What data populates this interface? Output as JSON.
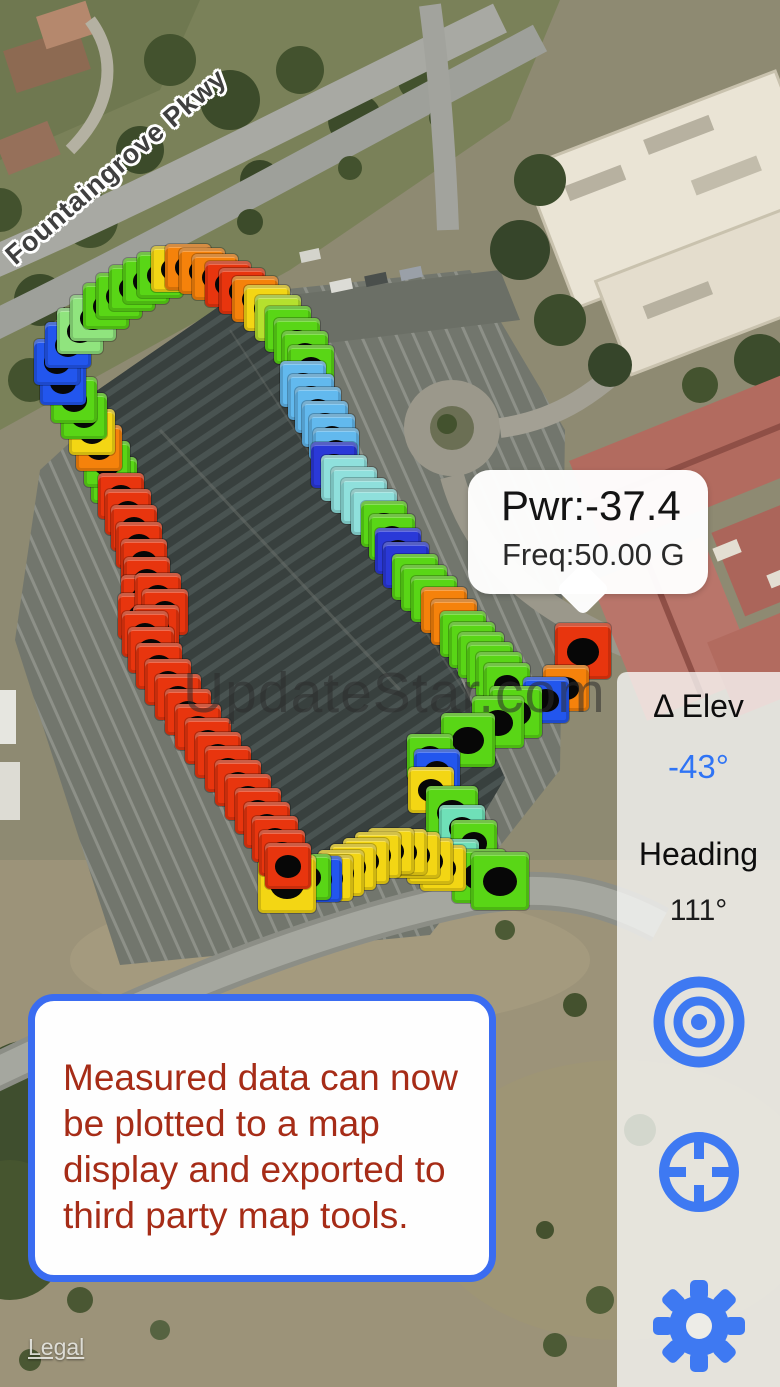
{
  "map": {
    "road_label": "Fountaingrove Pkwy",
    "legal_label": "Legal",
    "watermark": "UpdateStar.com"
  },
  "callout": {
    "power": "Pwr:-37.4",
    "freq": "Freq:50.00 G"
  },
  "sidebar": {
    "delta_elev_label": "Δ Elev",
    "delta_elev_value": "-43°",
    "heading_label": "Heading",
    "heading_value": "111°",
    "accent_color": "#3e79f2",
    "icons": [
      "bullseye-icon",
      "crosshair-icon",
      "gear-icon"
    ]
  },
  "note": {
    "lines": [
      "Measured data can now",
      "be plotted to a map",
      "display and exported to",
      "third party map tools."
    ],
    "text_color": "#a62c17",
    "border_color": "#3a6cf1"
  },
  "measurements": {
    "palette": {
      "r": "#e8350e",
      "o": "#f5820b",
      "y": "#f3d614",
      "yg": "#b5e02e",
      "g": "#59d616",
      "pg": "#90e47e",
      "cy": "#8fe0dc",
      "tl": "#6fe0b8",
      "sb": "#62b9ee",
      "bl": "#2256ee",
      "db": "#2a39d8"
    },
    "markers": [
      [
        114,
        480,
        "g"
      ],
      [
        107,
        464,
        "g"
      ],
      [
        99,
        448,
        "o"
      ],
      [
        92,
        432,
        "y"
      ],
      [
        84,
        416,
        "g"
      ],
      [
        74,
        400,
        "g"
      ],
      [
        63,
        382,
        "bl"
      ],
      [
        57,
        362,
        "bl"
      ],
      [
        68,
        345,
        "bl"
      ],
      [
        80,
        331,
        "pg"
      ],
      [
        93,
        318,
        "pg"
      ],
      [
        106,
        306,
        "g"
      ],
      [
        119,
        296,
        "g"
      ],
      [
        132,
        288,
        "g"
      ],
      [
        146,
        281,
        "g"
      ],
      [
        160,
        275,
        "g"
      ],
      [
        174,
        269,
        "y"
      ],
      [
        188,
        267,
        "o"
      ],
      [
        202,
        271,
        "o"
      ],
      [
        215,
        277,
        "o"
      ],
      [
        228,
        284,
        "r"
      ],
      [
        242,
        291,
        "r"
      ],
      [
        255,
        299,
        "o"
      ],
      [
        267,
        308,
        "y"
      ],
      [
        278,
        318,
        "yg"
      ],
      [
        288,
        329,
        "g"
      ],
      [
        297,
        341,
        "g"
      ],
      [
        305,
        354,
        "g"
      ],
      [
        311,
        368,
        "g"
      ],
      [
        303,
        384,
        "sb"
      ],
      [
        311,
        397,
        "sb"
      ],
      [
        318,
        410,
        "sb"
      ],
      [
        325,
        424,
        "sb"
      ],
      [
        332,
        437,
        "sb"
      ],
      [
        336,
        451,
        "sb"
      ],
      [
        334,
        465,
        "db"
      ],
      [
        344,
        478,
        "cy"
      ],
      [
        354,
        490,
        "cy"
      ],
      [
        364,
        501,
        "cy"
      ],
      [
        374,
        512,
        "cy"
      ],
      [
        384,
        524,
        "g"
      ],
      [
        392,
        537,
        "g"
      ],
      [
        398,
        551,
        "db"
      ],
      [
        406,
        565,
        "db"
      ],
      [
        415,
        577,
        "g"
      ],
      [
        424,
        588,
        "g"
      ],
      [
        434,
        599,
        "g"
      ],
      [
        444,
        610,
        "o"
      ],
      [
        454,
        622,
        "o"
      ],
      [
        463,
        634,
        "g"
      ],
      [
        472,
        645,
        "g"
      ],
      [
        481,
        655,
        "g"
      ],
      [
        490,
        665,
        "g"
      ],
      [
        499,
        675,
        "g"
      ],
      [
        507,
        686,
        "g"
      ],
      [
        583,
        651,
        "r",
        56
      ],
      [
        566,
        688,
        "o"
      ],
      [
        546,
        700,
        "bl"
      ],
      [
        516,
        712,
        "g",
        52
      ],
      [
        498,
        722,
        "g",
        52
      ],
      [
        468,
        740,
        "g",
        54
      ],
      [
        430,
        757,
        "g"
      ],
      [
        437,
        772,
        "bl"
      ],
      [
        431,
        790,
        "y"
      ],
      [
        452,
        812,
        "g",
        52
      ],
      [
        462,
        828,
        "tl"
      ],
      [
        474,
        843,
        "g"
      ],
      [
        456,
        862,
        "tl"
      ],
      [
        479,
        876,
        "g",
        54
      ],
      [
        500,
        881,
        "g",
        58
      ],
      [
        443,
        868,
        "y"
      ],
      [
        430,
        861,
        "y"
      ],
      [
        417,
        855,
        "y"
      ],
      [
        404,
        852,
        "y"
      ],
      [
        391,
        851,
        "y"
      ],
      [
        378,
        855,
        "y"
      ],
      [
        366,
        861,
        "y"
      ],
      [
        353,
        867,
        "y"
      ],
      [
        341,
        873,
        "y"
      ],
      [
        330,
        878,
        "y"
      ],
      [
        319,
        879,
        "bl"
      ],
      [
        308,
        877,
        "g"
      ],
      [
        287,
        884,
        "y",
        58
      ],
      [
        121,
        496,
        "r"
      ],
      [
        128,
        512,
        "r"
      ],
      [
        134,
        528,
        "r"
      ],
      [
        139,
        545,
        "r"
      ],
      [
        144,
        562,
        "r"
      ],
      [
        147,
        580,
        "r"
      ],
      [
        144,
        598,
        "r"
      ],
      [
        141,
        616,
        "r"
      ],
      [
        158,
        596,
        "r"
      ],
      [
        165,
        612,
        "r"
      ],
      [
        156,
        628,
        "r"
      ],
      [
        145,
        634,
        "r"
      ],
      [
        151,
        650,
        "r"
      ],
      [
        159,
        666,
        "r"
      ],
      [
        168,
        682,
        "r"
      ],
      [
        178,
        697,
        "r"
      ],
      [
        188,
        712,
        "r"
      ],
      [
        198,
        727,
        "r"
      ],
      [
        208,
        741,
        "r"
      ],
      [
        218,
        755,
        "r"
      ],
      [
        228,
        769,
        "r"
      ],
      [
        238,
        783,
        "r"
      ],
      [
        248,
        797,
        "r"
      ],
      [
        258,
        811,
        "r"
      ],
      [
        267,
        825,
        "r"
      ],
      [
        275,
        839,
        "r"
      ],
      [
        282,
        853,
        "r"
      ],
      [
        288,
        866,
        "r"
      ]
    ]
  }
}
